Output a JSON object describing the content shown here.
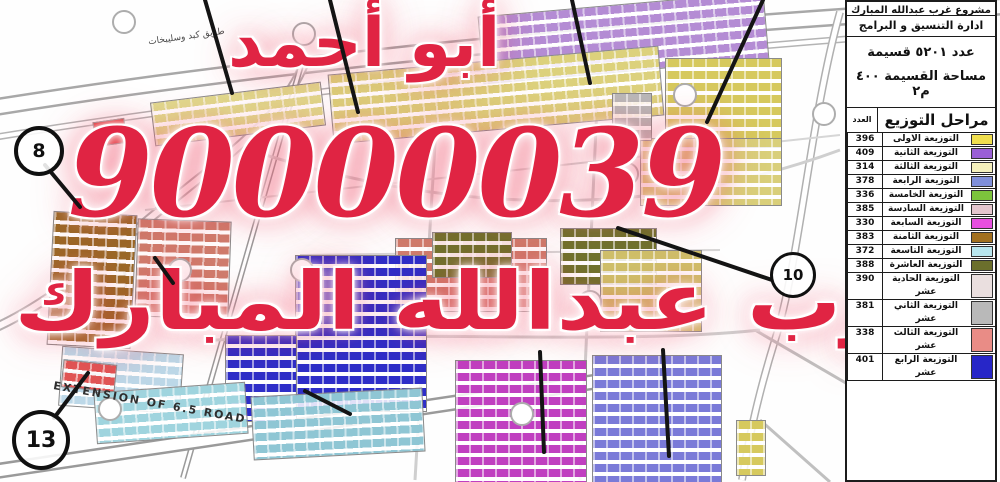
{
  "watermark": {
    "line1": "أبو أحمد",
    "line2": "90000039",
    "line3": "غرب عبدالله المبارك",
    "color": "#e02443"
  },
  "panel": {
    "title": "مشروع غرب عبدالله المبارك",
    "department": "ادارة التنسيق و البرامج",
    "stat_line1": "عدد  ٥٢٠١  قسيمة",
    "stat_line2": "مساحة القسيمة ٤٠٠ م٢",
    "legend_title": "مراحل التوزيع",
    "count_header": "العدد",
    "rows": [
      {
        "count": "396",
        "label": "التوزيعة الاولى",
        "color": "#f0df4e"
      },
      {
        "count": "409",
        "label": "التوزيعة الثانية",
        "color": "#9a5fd6"
      },
      {
        "count": "314",
        "label": "التوزيعة الثالثة",
        "color": "#f4f0bc"
      },
      {
        "count": "378",
        "label": "التوزيعة الرابعة",
        "color": "#7f8fd9"
      },
      {
        "count": "336",
        "label": "التوزيعة الخامسة",
        "color": "#7cc43c"
      },
      {
        "count": "385",
        "label": "التوزيعة السادسة",
        "color": "#e4c6ce"
      },
      {
        "count": "330",
        "label": "التوزيعة السابعة",
        "color": "#e84fe0"
      },
      {
        "count": "383",
        "label": "التوزيعة الثامنة",
        "color": "#a2701f"
      },
      {
        "count": "372",
        "label": "التوزيعة التاسعة",
        "color": "#b8e6ee"
      },
      {
        "count": "388",
        "label": "التوزيعة العاشرة",
        "color": "#6b6f2c"
      },
      {
        "count": "390",
        "label": "التوزيعة الحادية عشر",
        "color": "#eadfdf"
      },
      {
        "count": "381",
        "label": "التوزيعة الثاني عشر",
        "color": "#b9b9b9"
      },
      {
        "count": "338",
        "label": "التوزيعة الثالث عشر",
        "color": "#e98c86"
      },
      {
        "count": "401",
        "label": "التوزيعة الرابع عشر",
        "color": "#2726c8"
      }
    ]
  },
  "map": {
    "road_label_top": "طريق كبد وسليبخات",
    "road_label_bottom": "EXTENSION OF 6.5 ROAD",
    "callouts": [
      {
        "n": "8"
      },
      {
        "n": "13"
      },
      {
        "n": "10"
      }
    ]
  }
}
